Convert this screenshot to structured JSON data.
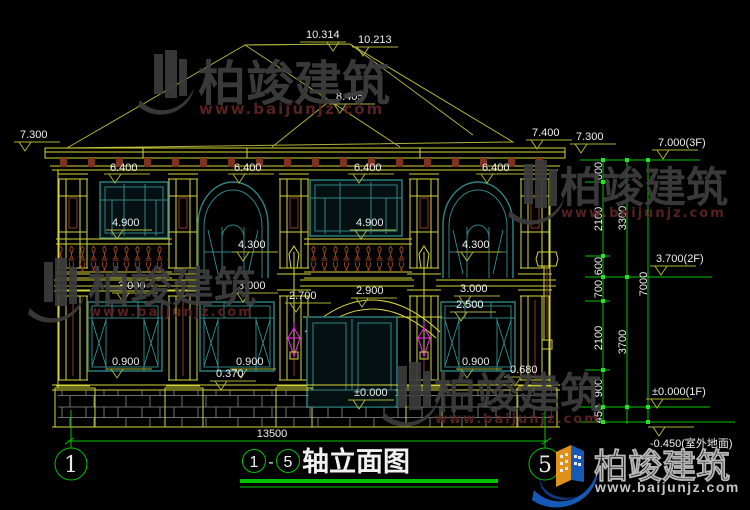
{
  "watermark": {
    "brand": "柏竣建筑",
    "site": "www.baijunjz.com"
  },
  "levels": {
    "ridge_left": "10.314",
    "ridge_right": "10.213",
    "mid_ridge": "8.405",
    "eave_left": "7.300",
    "eave_right_a": "7.400",
    "eave_right_b": "7.300",
    "floor3": "7.000(3F)",
    "floor2": "3.700(2F)",
    "floor1": "±0.000(1F)",
    "outdoor": "-0.450(室外地面)"
  },
  "dims": {
    "eave": "6.400",
    "rect_window_top": "4.900",
    "arch_window_top": "4.300",
    "floor1_window_top": "3.000",
    "porch_left": "2.700",
    "porch_peak": "2.900",
    "porch_right": "2.500",
    "sill": "0.900",
    "plinth_mid": "0.370",
    "plinth_right": "0.680",
    "door_zero": "±0.000",
    "total_width": "13500"
  },
  "chain": {
    "s600a": "600",
    "s2100a": "2100",
    "s600b": "600",
    "s700": "700",
    "s2100b": "2100",
    "s900": "900",
    "s450": "450",
    "t3300": "3300",
    "t3700": "3700",
    "t7000": "7000"
  },
  "axes": {
    "left": "1",
    "right": "5"
  },
  "title": {
    "start": "1",
    "dash": "-",
    "end": "5",
    "text": "轴立面图"
  }
}
